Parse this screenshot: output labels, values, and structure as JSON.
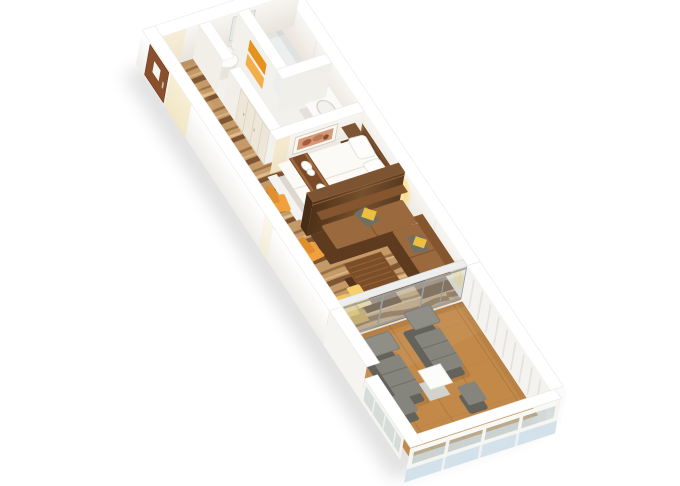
{
  "scene": {
    "title": "3D isometric floor plan of a cruise ship suite stateroom with private balcony",
    "rooms": [
      {
        "name": "entrance-hallway"
      },
      {
        "name": "bathroom"
      },
      {
        "name": "wardrobe-closet"
      },
      {
        "name": "bedroom"
      },
      {
        "name": "living-area"
      },
      {
        "name": "private-balcony"
      }
    ],
    "furniture": {
      "entrance": [
        "entry-door-with-notice",
        "zebra-pattern-carpet"
      ],
      "bathroom": [
        "toilet",
        "vanity-sink",
        "shower",
        "orange-towels",
        "wardrobe-doors",
        "mirror"
      ],
      "bedroom": [
        "double-bed-white-linens",
        "brown-bed-runner",
        "folded-towels-on-bed",
        "pillows",
        "nightstand",
        "headboard-panel",
        "framed-artwork",
        "vanity-desk",
        "orange-chair",
        "wall-sconces"
      ],
      "living": [
        "l-shaped-leather-sofa",
        "gray-pillows",
        "yellow-accent-pillows",
        "slatted-coffee-table",
        "sideboard",
        "orange-chair",
        "yellow-chaise",
        "ottoman"
      ],
      "balcony": [
        "sun-lounger",
        "sun-lounger",
        "footstool",
        "footstool",
        "white-side-table",
        "teak-deck",
        "white-railing-glass-panels"
      ]
    }
  },
  "colors": {
    "carpet_base": "#c49a68",
    "carpet_stripe_dark": "#75492a",
    "carpet_stripe_mid": "#96693e",
    "carpet_stripe_light": "#e6c795",
    "bath_floor": "#f2f1ed",
    "deck_wood": "#c28949",
    "deck_seam": "#a36d35",
    "sofa_base": "#5e3a1f",
    "sofa_seat": "#9a6a3e",
    "sofa_back": "#84552e",
    "pillow_gray": "#6f6f66",
    "pillow_yellow": "#eebf3f",
    "coffee_table": "#7c4e28",
    "sideboard": "#8a5a30",
    "chair_orange": "#f0a13d",
    "chaise_yellow": "#f2c65a",
    "bed_white": "#fbfaf6",
    "runner_brown": "#7a4a28",
    "headboard_brown": "#6b4526",
    "partition_wood_dark": "#4f3118",
    "partition_wood_light": "#74502c",
    "partition_top": "#7d5433",
    "towel_orange": "#e8921e",
    "towel_light": "#f3ad49",
    "lounger_gray": "#85857d",
    "lounger_back": "#8f8f88",
    "lounger_frame": "#63635c",
    "door_brown": "#8a4f2c",
    "glass_tint": "#b7c3c1",
    "frame_gray": "#99a0a2",
    "below_glass_blue": "#d3e1ea",
    "glow_yellow": "#ffd34d"
  }
}
